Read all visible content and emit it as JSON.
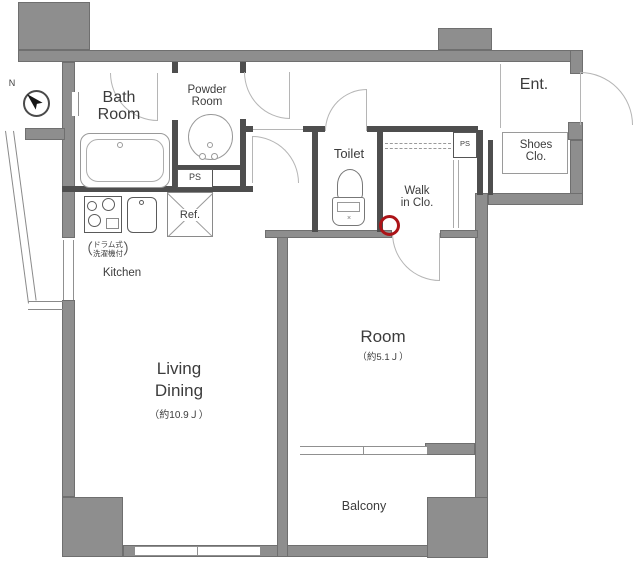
{
  "colors": {
    "wall": "#8e8e8e",
    "wall_edge": "#6f6f6f",
    "partition": "#4e4e4e",
    "fixture_line": "#999999",
    "door_arc": "#b5b5b5",
    "text": "#3c3c3c",
    "marker_red": "#ac1418"
  },
  "compass": {
    "north": "N"
  },
  "rooms": {
    "bath": {
      "line1": "Bath",
      "line2": "Room"
    },
    "powder": {
      "line1": "Powder",
      "line2": "Room"
    },
    "entry": {
      "label": "Ent."
    },
    "shoes_closet": {
      "line1": "Shoes",
      "line2": "Clo."
    },
    "toilet": {
      "label": "Toilet"
    },
    "walk_in_closet": {
      "line1": "Walk",
      "line2": "in Clo."
    },
    "room": {
      "label": "Room",
      "size": "（約5.1Ｊ）"
    },
    "living_dining": {
      "line1": "Living",
      "line2": "Dining",
      "size": "（約10.9Ｊ）"
    },
    "balcony": {
      "label": "Balcony"
    },
    "kitchen": {
      "label": "Kitchen"
    }
  },
  "fixtures": {
    "refrigerator": {
      "label": "Ref."
    },
    "pipe_space_1": {
      "label": "PS"
    },
    "pipe_space_2": {
      "label": "PS"
    },
    "washer_note": {
      "open_paren": "（",
      "line1": "ドラム式",
      "line2": "洗濯機付",
      "close_paren": "）"
    }
  }
}
